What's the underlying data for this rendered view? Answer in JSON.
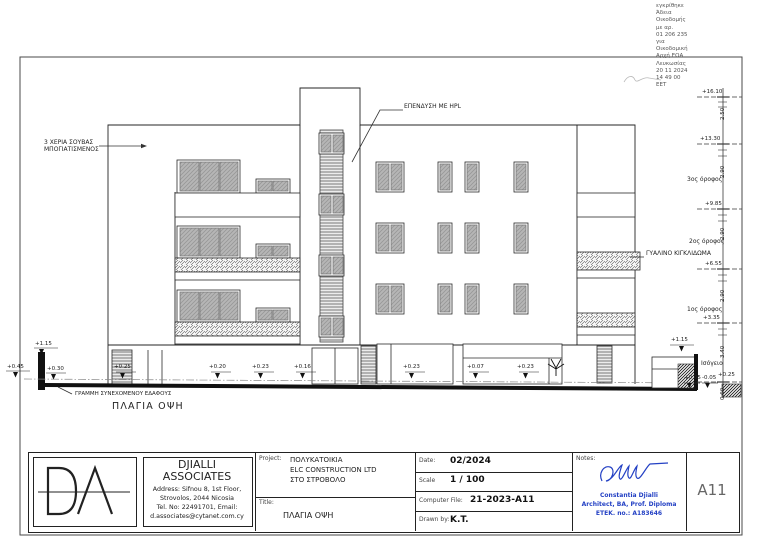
{
  "approval_stamp": {
    "lines": [
      "εγκρίθηκε",
      "Άδεια",
      "Οικοδομής",
      "με αρ.",
      "01 206 235",
      "για",
      "Οικοδομική",
      "Αρχή ΕΟΑ",
      "Λευκωσίας",
      "20 11 2024",
      "14 49 00",
      "EET"
    ]
  },
  "drawing": {
    "label": "ΠΛΑΓΙΑ ΟΨΗ",
    "annotations": {
      "plaster_1": "3 ΧΕΡΙΑ ΣΟΥΒΑΣ",
      "plaster_2": "ΜΠΟΓΙΑΤΙΣΜΕΝΟΣ",
      "hpl": "ΕΠΕΝΔΥΣΗ ΜΕ HPL",
      "glass_railing": "ΓΥΑΛΙΝΟ ΚΙΓΚΛΙΔΩΜΑ",
      "ground_line": "ΓΡΑΜΜΗ ΣΥΝΕΧΟΜΕΝΟΥ ΕΔΑΦΟΥΣ"
    },
    "floors": {
      "f3": "3ος όροφος",
      "f2": "2ος όροφος",
      "f1": "1ος όροφος",
      "gf": "Ισόγειο"
    },
    "levels": [
      "+16.10",
      "+13.30",
      "+9.85",
      "+6.55",
      "+3.35"
    ],
    "dims": [
      "2.50",
      "2.90",
      "2.90",
      "2.90",
      "3.40",
      "0.60"
    ],
    "spot_left": {
      "wall": "+1.15",
      "a": "+0.45",
      "b": "+0.30"
    },
    "spot_bottom": [
      "+0.25",
      "+0.20",
      "+0.23",
      "+0.16",
      "+0.23",
      "+0.07",
      "+0.23"
    ],
    "spot_right": {
      "wall": "+1.15",
      "a": "+0.05",
      "b": "-0.05",
      "c": "+0.25"
    }
  },
  "titleblock": {
    "firm": {
      "name1": "DJIALLI",
      "name2": "ASSOCIATES",
      "addr1": "Address: Sifnou 8, 1st Floor,",
      "addr2": "Strovolos, 2044 Nicosia",
      "addr3": "Tel. No: 22491701, Email:",
      "addr4": "d.associates@cytanet.com.cy"
    },
    "project": {
      "label": "Project:",
      "line1": "ΠΟΛΥΚΑΤΟΙΚΙΑ",
      "line2": "ELC CONSTRUCTION LTD",
      "line3": "ΣΤΟ ΣΤΡΟΒΟΛΟ"
    },
    "title": {
      "label": "Title:",
      "value": "ΠΛΑΓΙΑ ΟΨΗ"
    },
    "date": {
      "label": "Date:",
      "value": "02/2024"
    },
    "scale": {
      "label": "Scale",
      "value": "1 / 100"
    },
    "file": {
      "label": "Computer File:",
      "value": "21-2023-A11"
    },
    "drawn": {
      "label": "Drawn by:",
      "value": "K.T."
    },
    "notes": {
      "label": "Notes:",
      "architect1": "Constantia  Djialli",
      "architect2": "Architect, BA, Prof. Diploma",
      "architect3": "ETEK. no.: A183646"
    },
    "sheet": "A11"
  },
  "colors": {
    "ink": "#222222",
    "accent_blue": "#2441c4",
    "glass_grey": "#b6b6b6",
    "sheet_code_grey": "#666666"
  }
}
